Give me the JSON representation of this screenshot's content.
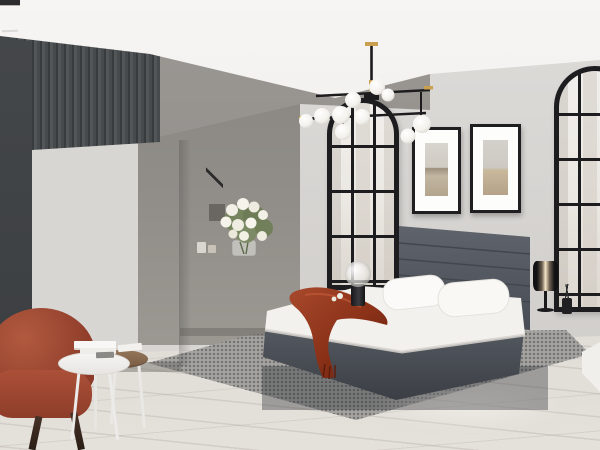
{
  "scene": {
    "description": "Bedroom furniture set product photo with clickable hotspot labels",
    "room": "bedroom with grey accent walls, arched black windows, chandelier, rug"
  },
  "hotspots": [
    {
      "id": "wardrobe",
      "label": "Шкаф 3дверный",
      "ring_side": "left"
    },
    {
      "id": "dresser",
      "label": "Комод",
      "ring_side": "left"
    },
    {
      "id": "nightstand",
      "label": "Тумба",
      "ring_side": "right"
    }
  ],
  "colors": {
    "hotspot_ring": "#d61f26",
    "pill_background": "#ffffff",
    "pill_text": "#0d0d0d",
    "accent_wall": "#4a4e50",
    "headboard": "#545860",
    "throw_blanket": "#8e3a22",
    "armchair": "#9c4732"
  }
}
